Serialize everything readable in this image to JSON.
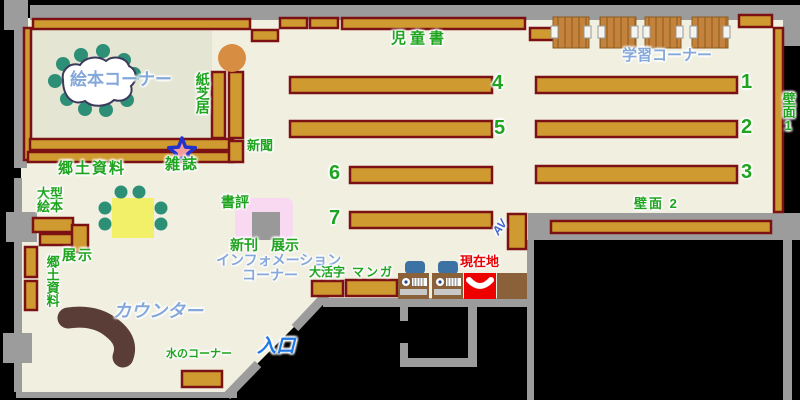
{
  "labels": {
    "picture_book_corner": "絵本コーナー",
    "kamishibai": "紙芝居",
    "newspaper": "新聞",
    "magazine": "雑誌",
    "local_materials": "郷土資料",
    "children_books": "児童書",
    "study_corner": "学習コーナー",
    "wall_1": "壁面1",
    "wall_2": "壁面 2",
    "book_review": "書評",
    "new_books": "新刊",
    "display_right": "展示",
    "info_line1": "インフォメーション",
    "info_line2": "コーナー",
    "large_picture_books_line1": "大型",
    "large_picture_books_line2": "絵本",
    "local_materials_vertical": "郷土資料",
    "display_left": "展示",
    "large_print": "大活字",
    "manga": "マンガ",
    "you_are_here": "現在地",
    "av": "AV",
    "counter": "カウンター",
    "water_corner": "水のコーナー",
    "entrance": "入口"
  },
  "shelf_numbers": {
    "s1": "1",
    "s2": "2",
    "s3": "3",
    "s4": "4",
    "s5": "5",
    "s6": "6",
    "s7": "7"
  },
  "colors": {
    "floor": "#F0EFE0",
    "picture_room_floor": "#E4E5D3",
    "shelf_fill": "#CF9A30",
    "shelf_border": "#7C1114",
    "wall_gray": "#9C9C9C",
    "outside": "#000000",
    "label_green": "#1FA41F",
    "label_light_blue": "#85A8DA",
    "entrance_blue": "#1E78E8",
    "current_location_red": "#E60000",
    "counter_brown": "#5A3D36",
    "table_yellow": "#F2EF68",
    "stool_green": "#2E8F77",
    "desk_wood": "#C5823C",
    "terminal_desk": "#8A6138",
    "chair_blue": "#3D72A4",
    "star_fill": "#F79C9C",
    "star_border": "#2233CC",
    "display_pink": "#F9D9F2"
  }
}
